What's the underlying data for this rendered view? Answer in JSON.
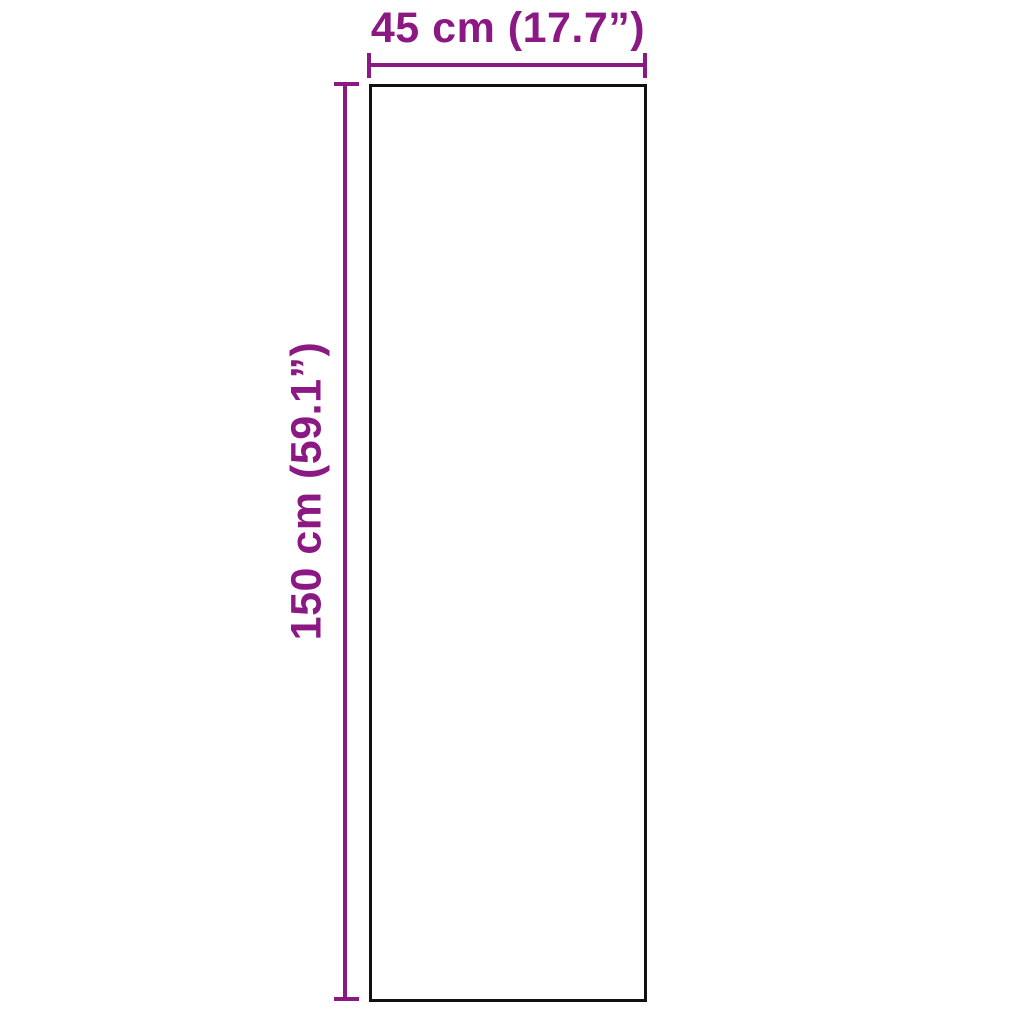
{
  "diagram": {
    "type": "product-dimensions",
    "width_label": "45 cm (17.7”)",
    "height_label": "150 cm (59.1”)",
    "width_value_cm": 45,
    "width_value_inch": 17.7,
    "height_value_cm": 150,
    "height_value_inch": 59.1,
    "accent_color": "#8b1883",
    "outline_color": "#111111",
    "background_color": "#ffffff"
  }
}
